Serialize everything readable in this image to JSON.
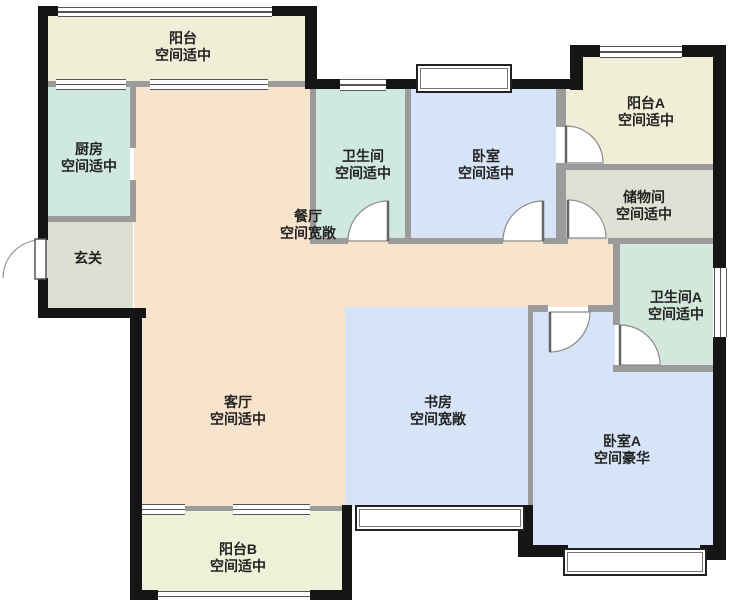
{
  "floorplan": {
    "type": "apartment-floor-plan",
    "rooms": [
      {
        "id": "balcony-top",
        "name": "阳台",
        "status": "空间适中"
      },
      {
        "id": "kitchen",
        "name": "厨房",
        "status": "空间适中"
      },
      {
        "id": "bathroom",
        "name": "卫生间",
        "status": "空间适中"
      },
      {
        "id": "bedroom",
        "name": "卧室",
        "status": "空间适中"
      },
      {
        "id": "balcony-a",
        "name": "阳台A",
        "status": "空间适中"
      },
      {
        "id": "storage",
        "name": "储物间",
        "status": "空间适中"
      },
      {
        "id": "dining",
        "name": "餐厅",
        "status": "空间宽敞"
      },
      {
        "id": "foyer",
        "name": "玄关",
        "status": ""
      },
      {
        "id": "bathroom-a",
        "name": "卫生间A",
        "status": "空间适中"
      },
      {
        "id": "living",
        "name": "客厅",
        "status": "空间适中"
      },
      {
        "id": "study",
        "name": "书房",
        "status": "空间宽敞"
      },
      {
        "id": "bedroom-a",
        "name": "卧室A",
        "status": "空间豪华"
      },
      {
        "id": "balcony-b",
        "name": "阳台B",
        "status": "空间适中"
      }
    ],
    "colors": {
      "balcony_floor": "#f1eed7",
      "balcony_b_floor": "#eff0d8",
      "kitchen_bathroom_floor": "#cfe8e1",
      "bathroom_a_floor": "#d3e8dc",
      "foyer_floor": "#dce0d2",
      "storage_floor": "#dee2d4",
      "living_dining_floor": "#f8e4cd",
      "bedroom_study_floor": "#d7e4f7",
      "exterior_wall": "#151515",
      "interior_wall": "#9b9b9b",
      "label_text": "#222222"
    }
  }
}
